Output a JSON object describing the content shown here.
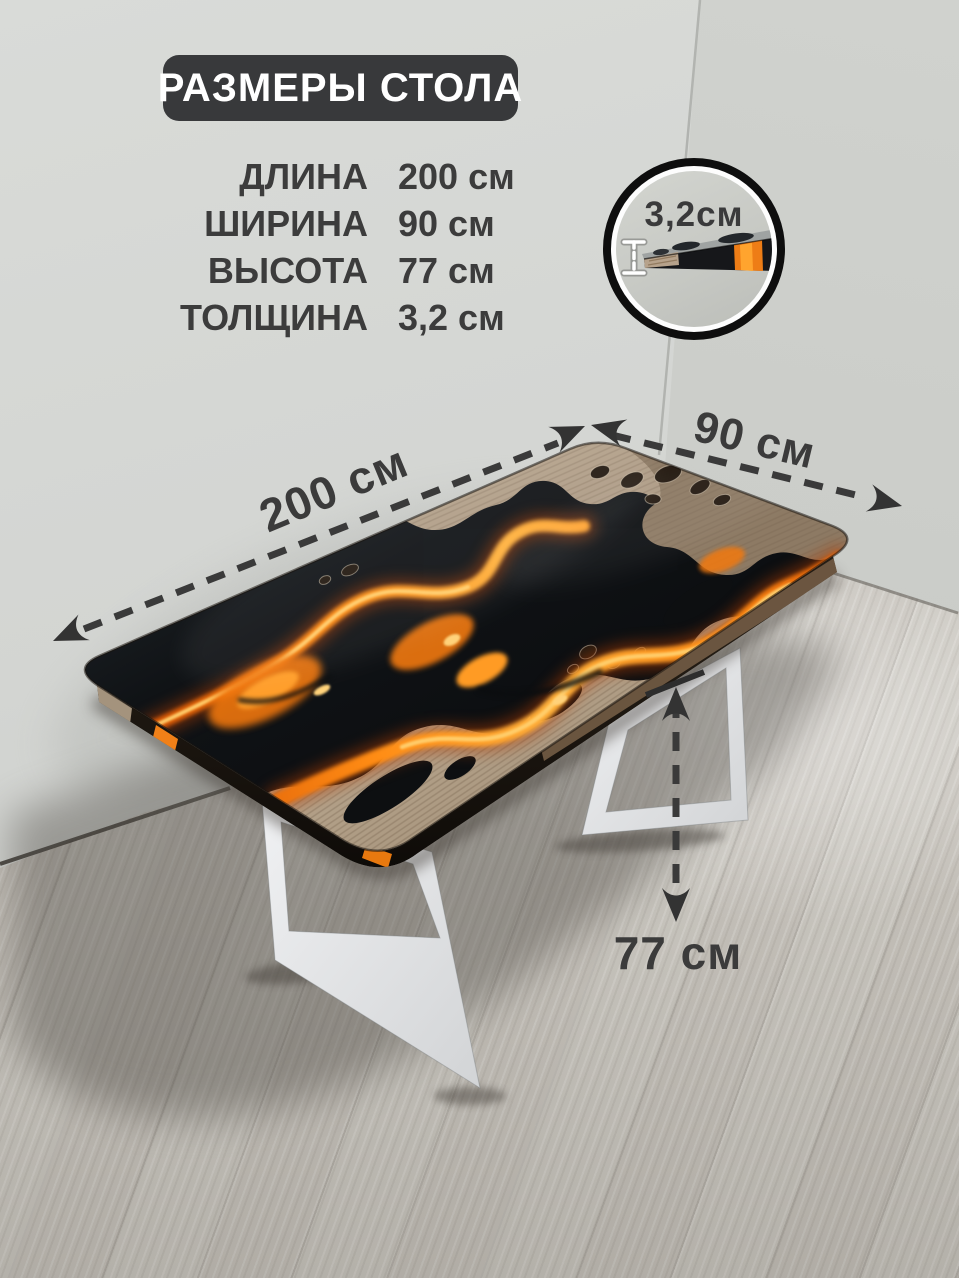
{
  "header": {
    "badge_label": "РАЗМЕРЫ СТОЛА"
  },
  "specs": {
    "rows": [
      {
        "label": "ДЛИНА",
        "value": "200 см"
      },
      {
        "label": "ШИРИНА",
        "value": "90 см"
      },
      {
        "label": "ВЫСОТА",
        "value": "77 см"
      },
      {
        "label": "ТОЛЩИНА",
        "value": "3,2 см"
      }
    ]
  },
  "dimensions": {
    "length": "200 см",
    "width": "90 см",
    "height": "77 см"
  },
  "inset": {
    "thickness_label": "3,2см"
  },
  "colors": {
    "badge_bg": "#38393b",
    "text_dark": "#3c3c3c",
    "dimension_line": "#3a3a3a",
    "lava_orange": "#f5821f",
    "resin_black": "#0d0f11",
    "leg_white": "#e7e8ea",
    "wall_gray": "#d2d4d1",
    "floor_gray": "#c4c0b9"
  }
}
